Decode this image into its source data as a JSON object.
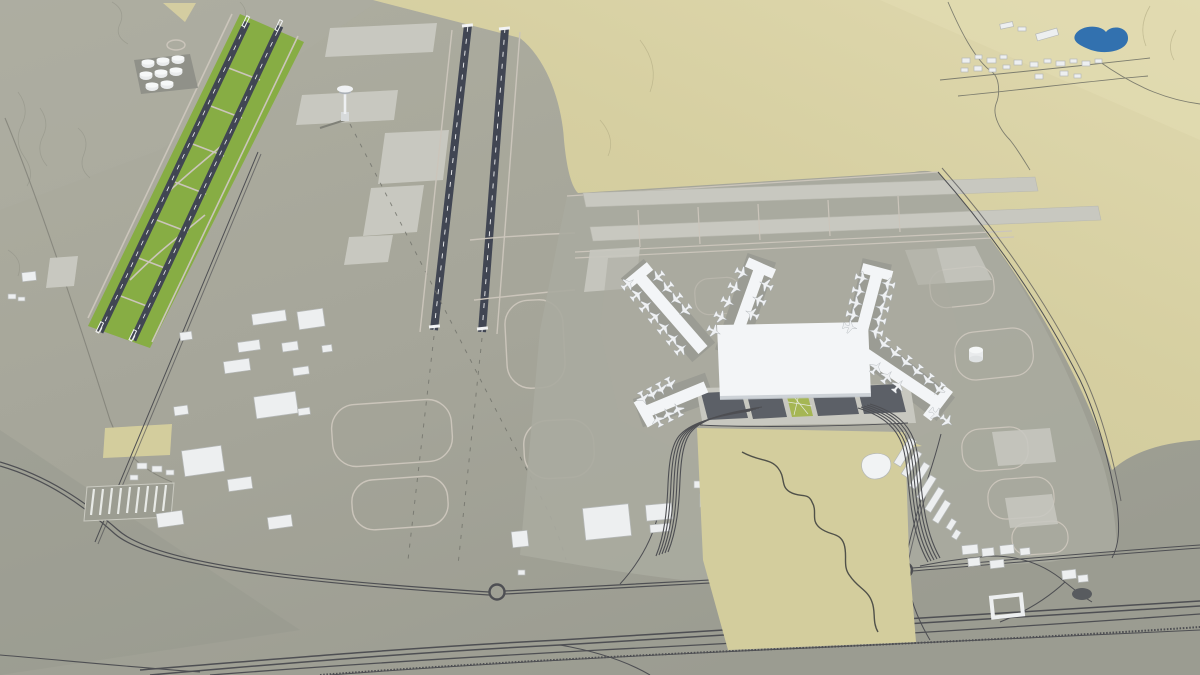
{
  "meta": {
    "title": "3D aerial rendering of an airport master plan model",
    "description": "Bird's-eye 3D visualization of a planned airport: two pairs of parallel runways with green infield strips on the west airfield, an X-shaped passenger terminal with five piers and parked aircraft, two light runway strips on the east airfield, landside parking lots, looping access road bundles, a highway and rail corridor along the south, industrial, cargo and support buildings, a fuel tank farm, a control tower and a helipad, all set in desert terrain with a small blue lake and a village to the north-east.",
    "visible_text": ""
  },
  "palette": {
    "ground": "#a5a598",
    "ground_light": "#aeaea1",
    "ground_dark": "#94958a",
    "desert": "#d6cfa0",
    "desert_light": "#e2dbb0",
    "sand_plot": "#d3cc9c",
    "apron": "#a9aa9e",
    "apron_light": "#c7c7bf",
    "apron_pale": "#d4d4cd",
    "taxiline": "#cac4ba",
    "stand_pad": "#9a9b92",
    "runway": "#3e4350",
    "runway_mark": "#f2f3f4",
    "green": "#85ac41",
    "green_light": "#a4b551",
    "terminal_white": "#f3f5f7",
    "terminal_shade": "#c6cbd1",
    "building": "#edeff0",
    "building_side": "#b4b7b6",
    "road_dark": "#4b4c50",
    "road_mid": "#77786f",
    "parking_dark": "#595d64",
    "lake_blue": "#2e6fae",
    "contour": "#8f9082",
    "shadow": "#7e7f76"
  },
  "scene": {
    "terrain": {
      "ground": "grey-green graded plain",
      "desert": "sand-coloured terrain to the north-east and a sand plot south of the terminal",
      "lake": "small blue pond beside the north-east village"
    },
    "airside": {
      "west_runways": 2,
      "center_runways": 2,
      "east_runway_strips": 2,
      "green_infield_strips": true,
      "control_tower": 1,
      "helipad": 1,
      "fuel_tanks": 8,
      "runway_style": "dark blue-grey with white centreline dashes and thresholds"
    },
    "terminal": {
      "shape": "X-shaped central hall",
      "piers": 5,
      "parked_aircraft": 47,
      "parking_lots": 5,
      "green_parking_strip": 1,
      "storage_tank": 1,
      "curved_roof_building": 1
    },
    "landside": {
      "roundabouts": 2,
      "highway_rail_corridor": 1,
      "bus_depot": 1,
      "industrial_buildings": 18,
      "village_buildings": 16,
      "southeast_buildings": 9,
      "cargo_buildings": 8
    }
  }
}
